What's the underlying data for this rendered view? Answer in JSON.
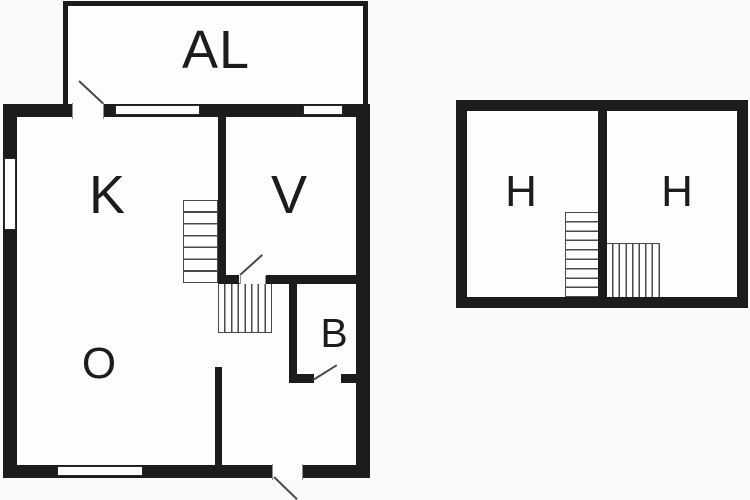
{
  "colors": {
    "background": "#fbfaf8",
    "room_fill": "#fefdfb",
    "wall": "#1d1c1a",
    "detail_line": "#4a4a48"
  },
  "plans": {
    "ground": {
      "rooms": [
        {
          "label": "AL"
        },
        {
          "label": "K"
        },
        {
          "label": "V"
        },
        {
          "label": "B"
        },
        {
          "label": "O"
        }
      ]
    },
    "upper": {
      "rooms": [
        {
          "label": "H"
        },
        {
          "label": "H"
        }
      ]
    }
  }
}
